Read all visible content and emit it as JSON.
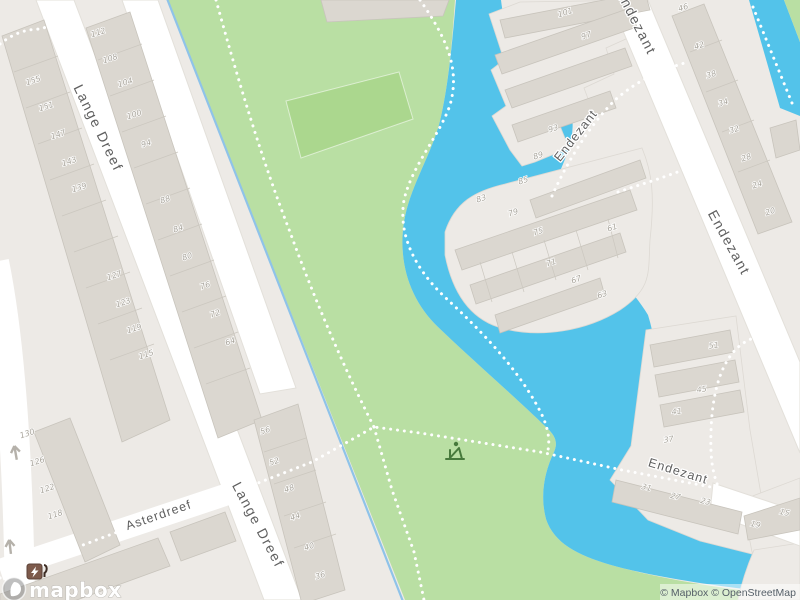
{
  "map": {
    "streets": {
      "lange_dreef": "Lange Dreef",
      "asterdreef": "Asterdreef",
      "endezant": "Endezant"
    },
    "house_numbers": [
      {
        "n": "155",
        "x": 34,
        "y": 83
      },
      {
        "n": "151",
        "x": 47,
        "y": 109
      },
      {
        "n": "147",
        "x": 59,
        "y": 137
      },
      {
        "n": "143",
        "x": 70,
        "y": 164
      },
      {
        "n": "139",
        "x": 80,
        "y": 190
      },
      {
        "n": "127",
        "x": 115,
        "y": 278
      },
      {
        "n": "123",
        "x": 124,
        "y": 305
      },
      {
        "n": "119",
        "x": 135,
        "y": 331
      },
      {
        "n": "115",
        "x": 147,
        "y": 357
      },
      {
        "n": "130",
        "x": 28,
        "y": 436
      },
      {
        "n": "126",
        "x": 38,
        "y": 464
      },
      {
        "n": "122",
        "x": 48,
        "y": 491
      },
      {
        "n": "118",
        "x": 56,
        "y": 517
      },
      {
        "n": "112",
        "x": 99,
        "y": 35
      },
      {
        "n": "108",
        "x": 111,
        "y": 61
      },
      {
        "n": "104",
        "x": 126,
        "y": 85
      },
      {
        "n": "100",
        "x": 135,
        "y": 117
      },
      {
        "n": "94",
        "x": 147,
        "y": 146
      },
      {
        "n": "88",
        "x": 166,
        "y": 202
      },
      {
        "n": "84",
        "x": 179,
        "y": 231
      },
      {
        "n": "80",
        "x": 188,
        "y": 259
      },
      {
        "n": "76",
        "x": 206,
        "y": 288
      },
      {
        "n": "72",
        "x": 216,
        "y": 316
      },
      {
        "n": "64",
        "x": 231,
        "y": 344
      },
      {
        "n": "56",
        "x": 266,
        "y": 433
      },
      {
        "n": "52",
        "x": 275,
        "y": 464
      },
      {
        "n": "48",
        "x": 290,
        "y": 491
      },
      {
        "n": "44",
        "x": 296,
        "y": 519
      },
      {
        "n": "40",
        "x": 310,
        "y": 549
      },
      {
        "n": "36",
        "x": 321,
        "y": 578
      },
      {
        "n": "101",
        "x": 566,
        "y": 15
      },
      {
        "n": "97",
        "x": 587,
        "y": 38
      },
      {
        "n": "93",
        "x": 554,
        "y": 131
      },
      {
        "n": "89",
        "x": 539,
        "y": 158
      },
      {
        "n": "85",
        "x": 524,
        "y": 183
      },
      {
        "n": "83",
        "x": 482,
        "y": 201
      },
      {
        "n": "79",
        "x": 514,
        "y": 215
      },
      {
        "n": "75",
        "x": 539,
        "y": 234
      },
      {
        "n": "71",
        "x": 552,
        "y": 265
      },
      {
        "n": "67",
        "x": 577,
        "y": 282
      },
      {
        "n": "63",
        "x": 603,
        "y": 297
      },
      {
        "n": "61",
        "x": 613,
        "y": 230
      },
      {
        "n": "46",
        "x": 684,
        "y": 10
      },
      {
        "n": "42",
        "x": 700,
        "y": 48
      },
      {
        "n": "38",
        "x": 712,
        "y": 77
      },
      {
        "n": "34",
        "x": 724,
        "y": 105
      },
      {
        "n": "32",
        "x": 735,
        "y": 132
      },
      {
        "n": "28",
        "x": 747,
        "y": 160
      },
      {
        "n": "24",
        "x": 758,
        "y": 187
      },
      {
        "n": "20",
        "x": 771,
        "y": 214
      },
      {
        "n": "51",
        "x": 714,
        "y": 348,
        "r": -8
      },
      {
        "n": "45",
        "x": 702,
        "y": 392,
        "r": -8
      },
      {
        "n": "41",
        "x": 677,
        "y": 414,
        "r": -8
      },
      {
        "n": "37",
        "x": 669,
        "y": 442,
        "r": -8
      },
      {
        "n": "31",
        "x": 646,
        "y": 490,
        "r": 13
      },
      {
        "n": "27",
        "x": 675,
        "y": 499,
        "r": 13
      },
      {
        "n": "23",
        "x": 705,
        "y": 504,
        "r": 13
      },
      {
        "n": "19",
        "x": 755,
        "y": 527,
        "r": 13
      },
      {
        "n": "15",
        "x": 784,
        "y": 515,
        "r": 13
      }
    ],
    "icons": {
      "charging_station": "charging-station-icon",
      "playground": "playground-icon",
      "one_way": "one-way-arrow-icon"
    },
    "colors": {
      "land": "#edeae6",
      "park": "#b9dfa3",
      "pitch": "#abd78e",
      "water": "#53c3ea",
      "stream": "#8fc3e9",
      "road": "#ffffff",
      "building": "#dbd7d0",
      "ev_brown": "#7d5a4b",
      "playground_green": "#477a3c"
    },
    "logo": {
      "text": "mapbox"
    },
    "attribution": {
      "text": "© Mapbox © OpenStreetMap"
    }
  }
}
